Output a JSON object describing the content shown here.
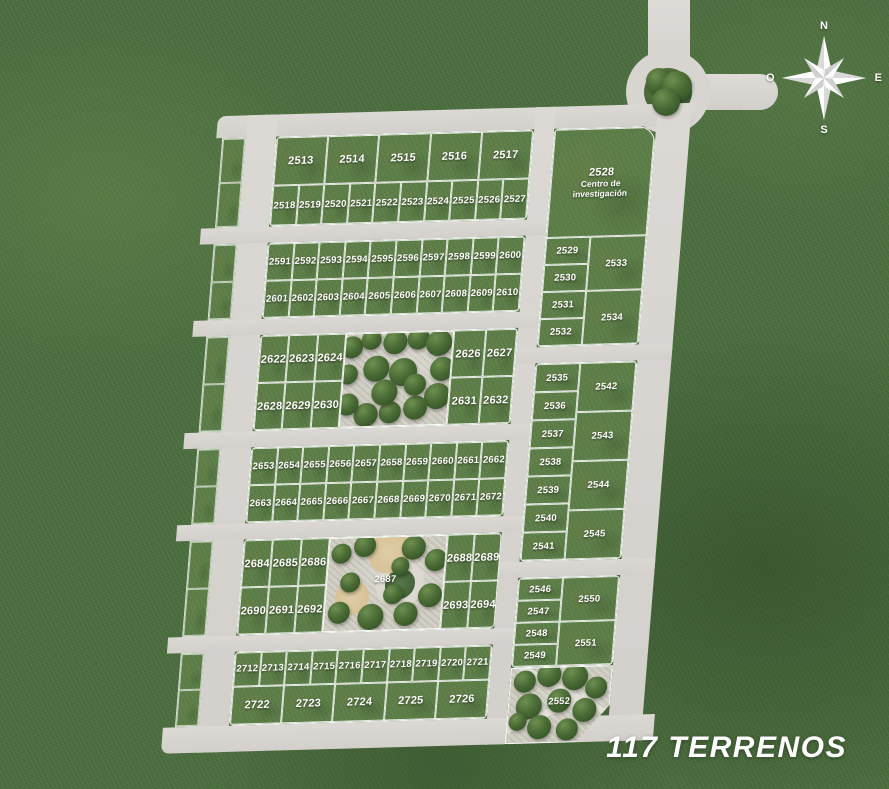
{
  "title": "117 TERRENOS",
  "compass": {
    "n": "N",
    "e": "E",
    "s": "S",
    "o": "O"
  },
  "colors": {
    "grass": "#4c6f3f",
    "lot": "#5d7f48",
    "road": "#d8d5d1",
    "line": "#ffffff",
    "gravel": "#d6d3c9",
    "tree": "#2c4a22",
    "treelight": "#6d9050",
    "sand": "#d4bd90",
    "text": "#ffffff"
  },
  "main_blocks": [
    {
      "type": "grid",
      "row_flex": [
        55,
        45
      ],
      "rows": [
        [
          "2513",
          "2514",
          "2515",
          "2516",
          "2517"
        ],
        [
          "2518",
          "2519",
          "2520",
          "2521",
          "2522",
          "2523",
          "2524",
          "2525",
          "2526",
          "2527"
        ]
      ]
    },
    {
      "type": "grid",
      "row_flex": [
        50,
        50
      ],
      "rows": [
        [
          "2591",
          "2592",
          "2593",
          "2594",
          "2595",
          "2596",
          "2597",
          "2598",
          "2599",
          "2600"
        ],
        [
          "2601",
          "2602",
          "2603",
          "2604",
          "2605",
          "2606",
          "2607",
          "2608",
          "2609",
          "2610"
        ]
      ]
    },
    {
      "type": "park-mid",
      "park_class": "park-c",
      "park_w": 108,
      "left_w": 85,
      "park_label": "",
      "left_rows": [
        [
          "2622",
          "2623",
          "2624"
        ],
        [
          "2628",
          "2629",
          "2630"
        ]
      ],
      "right_rows": [
        [
          "2626",
          "2627"
        ],
        [
          "2631",
          "2632"
        ]
      ]
    },
    {
      "type": "grid",
      "row_flex": [
        50,
        50
      ],
      "rows": [
        [
          "2653",
          "2654",
          "2655",
          "2656",
          "2657",
          "2658",
          "2659",
          "2660",
          "2661",
          "2662"
        ],
        [
          "2663",
          "2664",
          "2665",
          "2666",
          "2667",
          "2668",
          "2669",
          "2670",
          "2671",
          "2672"
        ]
      ]
    },
    {
      "type": "park-mid",
      "park_class": "park-e",
      "park_w": 118,
      "left_w": 85,
      "park_label": "2687",
      "left_rows": [
        [
          "2684",
          "2685",
          "2686"
        ],
        [
          "2690",
          "2691",
          "2692"
        ]
      ],
      "right_rows": [
        [
          "2688",
          "2689"
        ],
        [
          "2693",
          "2694"
        ]
      ]
    },
    {
      "type": "grid",
      "row_flex": [
        47,
        53
      ],
      "rows": [
        [
          "2712",
          "2713",
          "2714",
          "2715",
          "2716",
          "2717",
          "2718",
          "2719",
          "2720",
          "2721"
        ],
        [
          "2722",
          "2723",
          "2724",
          "2725",
          "2726"
        ]
      ]
    }
  ],
  "right_blocks": [
    {
      "header": {
        "number": "2528",
        "label": "Centro de investigación"
      },
      "header_h": 108,
      "left": [
        "2529",
        "2530",
        "2531",
        "2532"
      ],
      "right": [
        "2533",
        "2534"
      ]
    },
    {
      "left": [
        "2535",
        "2536",
        "2537",
        "2538",
        "2539",
        "2540",
        "2541"
      ],
      "right": [
        "2542",
        "2543",
        "2544",
        "2545"
      ]
    },
    {
      "left": [
        "2546",
        "2547",
        "2548",
        "2549"
      ],
      "right": [
        "2550",
        "2551"
      ]
    }
  ],
  "south_park_label": "2552"
}
